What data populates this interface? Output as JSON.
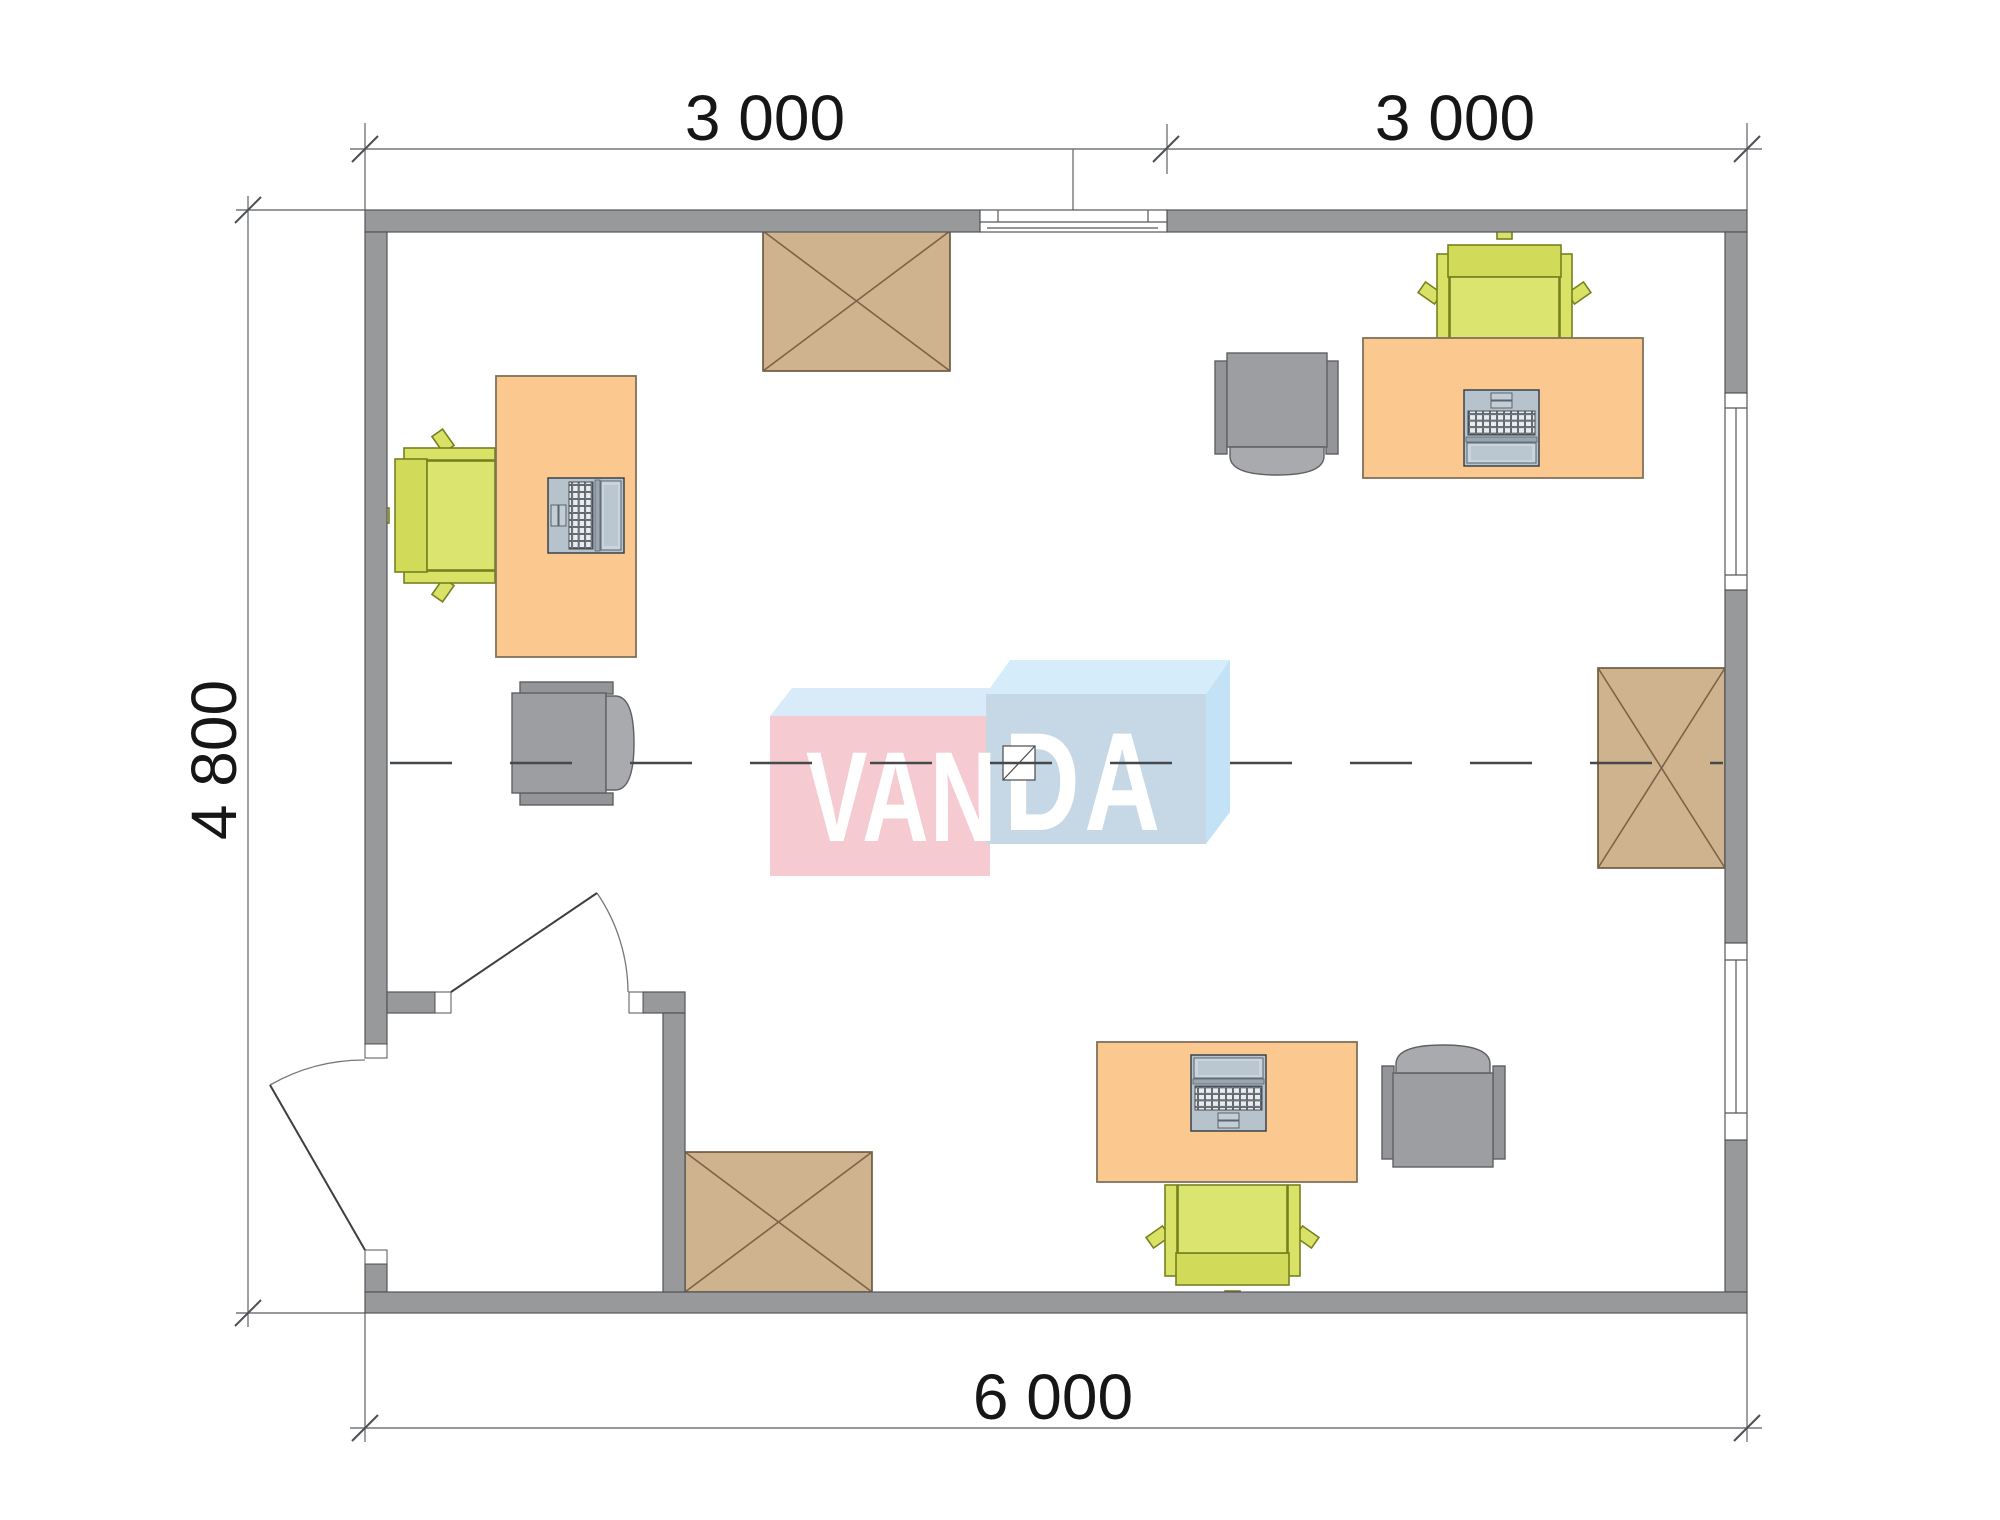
{
  "page": {
    "type": "office floor plan drawing",
    "background": "#ffffff"
  },
  "dimensions": {
    "top_left_span": "3 000",
    "top_right_span": "3 000",
    "left_span": "4 800",
    "bottom_span": "6 000"
  },
  "watermark": {
    "brand": "VANDA",
    "part_left": "VAN",
    "part_right": "DA",
    "pink_face": "#f5cad0",
    "pink_top_face": "#d9ebf8",
    "blue_face": "#c6d7e6",
    "blue_top_face": "#d5ecfa",
    "blue_side_face": "#c3e2f6",
    "letter_color": "#ffffff"
  },
  "colors": {
    "wall": "#97999b",
    "wall_outline": "#53565a",
    "desk": "#fbc990",
    "task_chair": "#d9e167",
    "lounge_chair": "#9c9ea1",
    "crossed_cabinet": "#cfb28e",
    "laptop_body": "#b6c2cc",
    "dash_centerline": "#46494c",
    "dimension_line": "#74777b",
    "dimension_text": "#161616"
  },
  "furniture_counts": {
    "desks": 3,
    "laptops": 3,
    "task_chairs": 3,
    "lounge_chairs": 3,
    "crossed_cabinets": 3,
    "windows": 3,
    "doors": 2
  }
}
